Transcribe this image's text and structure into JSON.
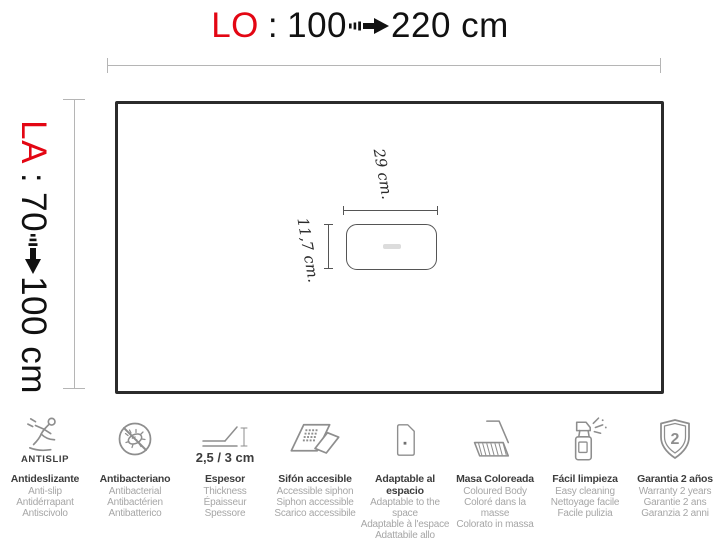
{
  "colors": {
    "accent_red": "#e30613",
    "outline_dark": "#2b2b2b",
    "dimension_gray": "#b5b5b5",
    "icon_gray": "#8e8e8e",
    "caption_title_gray": "#3d3d3d",
    "caption_sub_gray": "#a6a6a6"
  },
  "header": {
    "label": "LO",
    "colon": ":",
    "from": "100",
    "to": "220 cm"
  },
  "side": {
    "label": "LA",
    "colon": ":",
    "from": "70",
    "to": "100 cm"
  },
  "drain": {
    "width_label": "29 cm.",
    "height_label": "11,7 cm."
  },
  "features": [
    {
      "icon": "antislip-icon",
      "icon_caption": "ANTISLIP",
      "title": "Antideslizante",
      "lines": [
        "Anti-slip",
        "Antidérrapant",
        "Antiscivolo"
      ]
    },
    {
      "icon": "antibacterial-icon",
      "title": "Antibacteriano",
      "lines": [
        "Antibacterial",
        "Antibactérien",
        "Antibatterico"
      ]
    },
    {
      "icon": "thickness-icon",
      "icon_caption": "2,5 / 3 cm",
      "title": "Espesor",
      "lines": [
        "Thickness",
        "Épaisseur",
        "Spessore"
      ]
    },
    {
      "icon": "accessible-siphon-icon",
      "title": "Sifón accesible",
      "lines": [
        "Accessible siphon",
        "Siphon accessible",
        "Scarico accessibile"
      ]
    },
    {
      "icon": "adaptable-icon",
      "title": "Adaptable al espacio",
      "lines": [
        "Adaptable to the space",
        "Adaptable à l'espace",
        "Adattabile allo spazio"
      ]
    },
    {
      "icon": "colored-body-icon",
      "title": "Masa Coloreada",
      "lines": [
        "Coloured Body",
        "Coloré dans la masse",
        "Colorato in massa"
      ]
    },
    {
      "icon": "easy-cleaning-icon",
      "title": "Fácil limpieza",
      "lines": [
        "Easy cleaning",
        "Nettoyage facile",
        "Facile pulizia"
      ]
    },
    {
      "icon": "warranty-icon",
      "badge": "2",
      "title": "Garantia 2 años",
      "lines": [
        "Warranty 2 years",
        "Garantie 2 ans",
        "Garanzia 2 anni"
      ]
    }
  ]
}
